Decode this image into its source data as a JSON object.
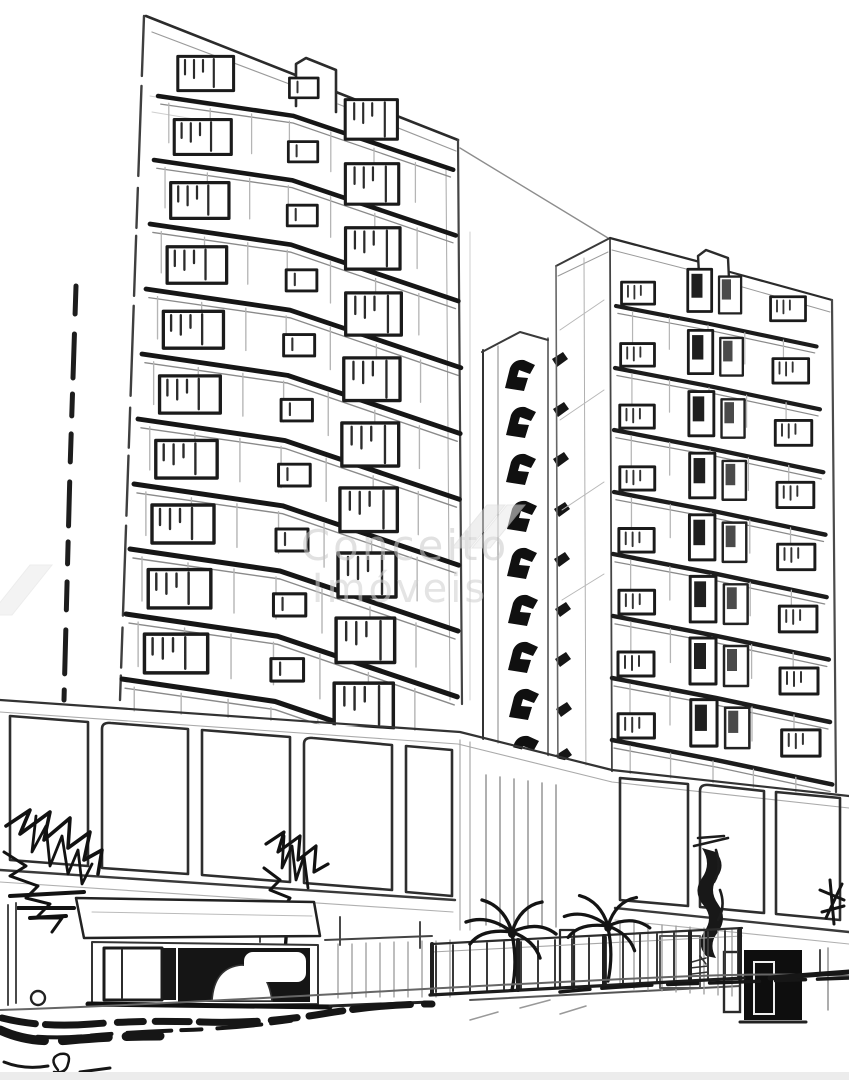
{
  "meta": {
    "type": "monochrome architectural sketch",
    "description": "Hand-drawn style line rendering of two high-rise residential towers with balcony bands, a narrow dark balcony core between them, a glazed podium, street-level storefronts, palm trees, foliage scribbles and a shaded street in the foreground.",
    "background_color": "#ffffff",
    "ink_color": "#1a1a1a",
    "midtone_color": "#8a8a8a",
    "light_line_color": "#bdbdbd"
  },
  "watermark": {
    "line1": "Conceito",
    "line2": "Imóveis",
    "color": "#d0d0d0",
    "logo": "double-parallelogram"
  },
  "scene": {
    "left_tower_floors": 10,
    "right_tower_floors": 8,
    "core_balconies": 9,
    "palm_trees": 2
  }
}
